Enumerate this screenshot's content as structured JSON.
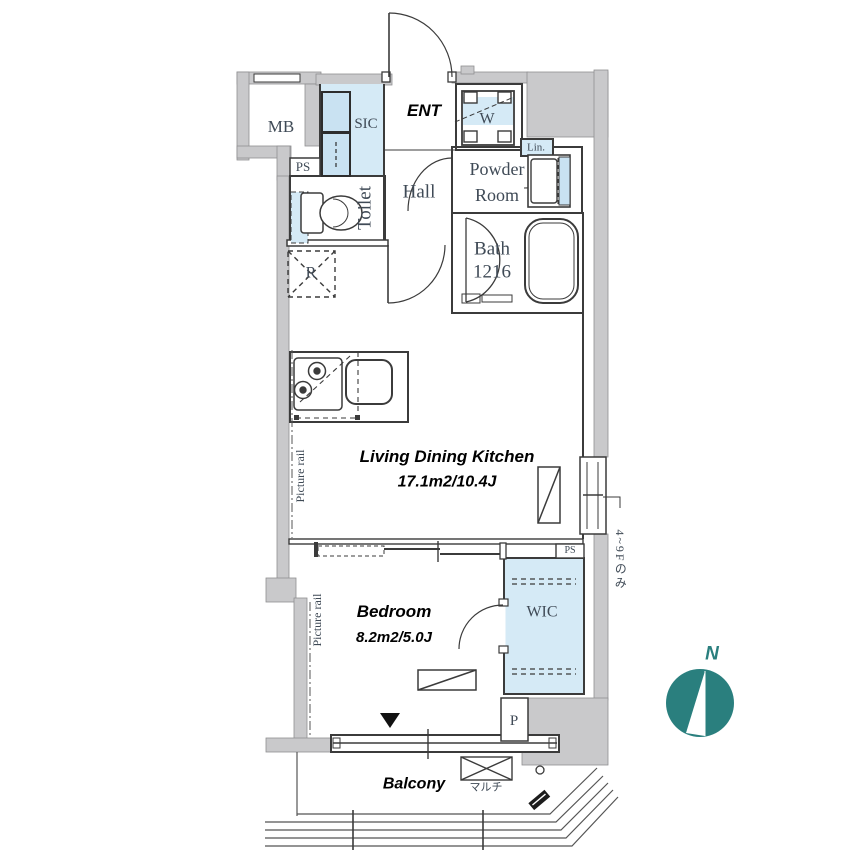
{
  "title": "apartment-floor-plan",
  "colors": {
    "wall_gray": "#c9c9cb",
    "room_blue": "#d5eaf6",
    "cabinet_blue": "#c9e2f2",
    "line": "#3b3b3b",
    "label_text": "#3f4a56",
    "accent_text": "#000000",
    "compass_teal": "#2a7f7e"
  },
  "labels": {
    "mb": "MB",
    "ps_top": "PS",
    "sic": "SIC",
    "ent": "ENT",
    "washer": "W",
    "linen": "Lin.",
    "powder_1": "Powder",
    "powder_2": "Room",
    "hall": "Hall",
    "toilet": "Toilet",
    "refrigerator": "R",
    "bath_1": "Bath",
    "bath_2": "1216",
    "ldk_name": "Living Dining Kitchen",
    "ldk_size": "17.1m2/10.4J",
    "picture_rail_ldk": "Picture rail",
    "picture_rail_bedroom": "Picture rail",
    "bedroom_name": "Bedroom",
    "bedroom_size": "8.2m2/5.0J",
    "wic": "WIC",
    "ps_mid": "PS",
    "parking": "P",
    "balcony": "Balcony",
    "multi": "マルチ",
    "floors_note": "4~9Fのみ",
    "north": "N"
  },
  "icons": {
    "compass": "compass-north-icon",
    "stove": "stove-burners-icon",
    "sink": "kitchen-sink-icon",
    "bathtub": "bathtub-icon",
    "toilet": "toilet-fixture-icon",
    "washing_machine": "washing-machine-icon",
    "window_marker": "window-triangle-marker"
  }
}
